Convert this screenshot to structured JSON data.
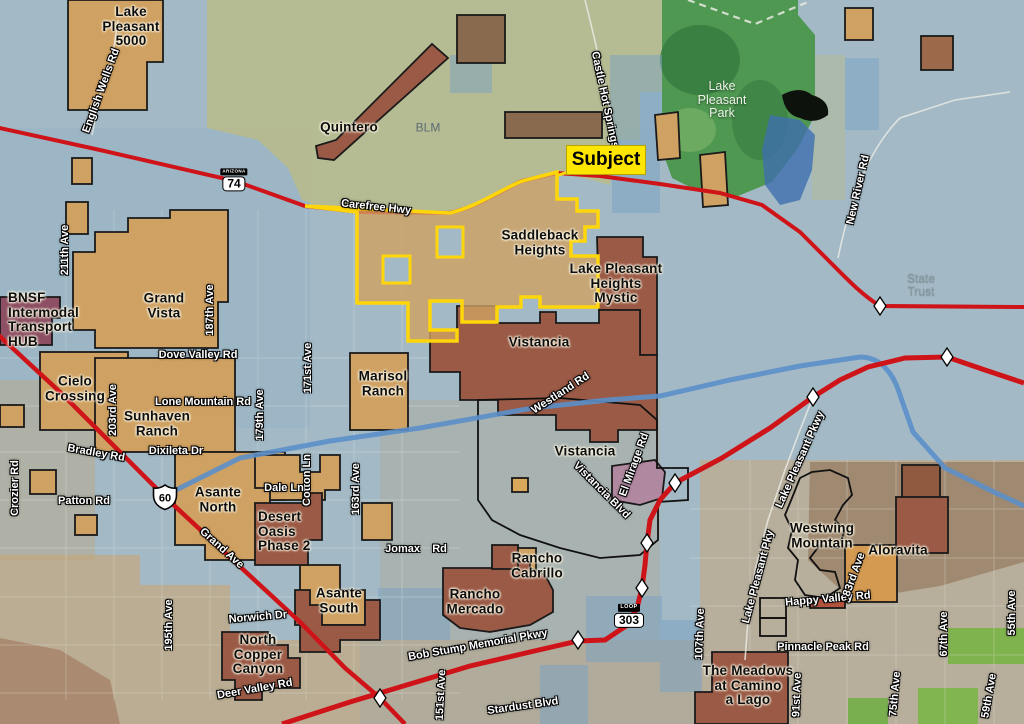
{
  "map": {
    "callout": {
      "label": "Subject"
    },
    "colors": {
      "base_water_blue": "#a3bac6",
      "blm_olive": "#b6ba90",
      "park_green": "#4f9851",
      "parcel_tan": "#cfa162",
      "parcel_red_brown": "#9a5a46",
      "parcel_purple": "#8d4f63",
      "parcel_mauve": "#b088a0",
      "highway_red": "#cf1419",
      "subject_yellow": "#ffd60a",
      "river_blue": "#5b8fc9",
      "diamond_white": "#ffffff"
    },
    "area_labels": [
      {
        "name": "label-lake-pleasant-5000",
        "text": "Lake\nPleasant\n5000",
        "x": 131,
        "y": 27,
        "style": "community"
      },
      {
        "name": "label-quintero",
        "text": "Quintero",
        "x": 349,
        "y": 128,
        "style": "community"
      },
      {
        "name": "label-blm",
        "text": "BLM",
        "x": 428,
        "y": 128,
        "style": "dim"
      },
      {
        "name": "label-lake-pleasant-park",
        "text": "Lake\nPleasant\nPark",
        "x": 722,
        "y": 100,
        "style": "park"
      },
      {
        "name": "label-saddleback-heights",
        "text": "Saddleback\nHeights",
        "x": 540,
        "y": 243,
        "style": "community"
      },
      {
        "name": "label-lake-pleasant-heights-mystic",
        "text": "Lake Pleasant\nHeights\nMystic",
        "x": 616,
        "y": 284,
        "style": "community"
      },
      {
        "name": "label-vistancia-north",
        "text": "Vistancia",
        "x": 539,
        "y": 343,
        "style": "community"
      },
      {
        "name": "label-vistancia-south",
        "text": "Vistancia",
        "x": 585,
        "y": 452,
        "style": "community"
      },
      {
        "name": "label-grand-vista",
        "text": "Grand\nVista",
        "x": 164,
        "y": 306,
        "style": "community"
      },
      {
        "name": "label-bnsf-hub",
        "text": "BNSF\nIntermodal\nTransport\nHUB",
        "x": 8,
        "y": 320,
        "style": "community",
        "align": "left"
      },
      {
        "name": "label-cielo-crossing",
        "text": "Cielo\nCrossing",
        "x": 75,
        "y": 389,
        "style": "community"
      },
      {
        "name": "label-sunhaven-ranch",
        "text": "Sunhaven\nRanch",
        "x": 157,
        "y": 424,
        "style": "community"
      },
      {
        "name": "label-marisol-ranch",
        "text": "Marisol\nRanch",
        "x": 383,
        "y": 384,
        "style": "community"
      },
      {
        "name": "label-asante-north",
        "text": "Asante\nNorth",
        "x": 218,
        "y": 500,
        "style": "community"
      },
      {
        "name": "label-desert-oasis-phase-2",
        "text": "Desert\nOasis\nPhase 2",
        "x": 258,
        "y": 532,
        "style": "community",
        "align": "left"
      },
      {
        "name": "label-asante-south",
        "text": "Asante\nSouth",
        "x": 339,
        "y": 601,
        "style": "community"
      },
      {
        "name": "label-north-copper-canyon",
        "text": "North\nCopper\nCanyon",
        "x": 258,
        "y": 655,
        "style": "community"
      },
      {
        "name": "label-rancho-cabrillo",
        "text": "Rancho\nCabrillo",
        "x": 537,
        "y": 566,
        "style": "community"
      },
      {
        "name": "label-rancho-mercado",
        "text": "Rancho\nMercado",
        "x": 475,
        "y": 602,
        "style": "community"
      },
      {
        "name": "label-westwing-mountain",
        "text": "Westwing\nMountain",
        "x": 822,
        "y": 536,
        "style": "community"
      },
      {
        "name": "label-aloravita",
        "text": "Aloravita",
        "x": 898,
        "y": 551,
        "style": "community"
      },
      {
        "name": "label-the-meadows-at-camino-a-lago",
        "text": "The Meadows\nat Camino\na Lago",
        "x": 748,
        "y": 686,
        "style": "community"
      },
      {
        "name": "label-state-trust",
        "text": "State\nTrust",
        "x": 921,
        "y": 285,
        "style": "dim-light"
      }
    ],
    "road_labels": [
      {
        "text": "English Wells Rd",
        "x": 102,
        "y": 91,
        "r": -70
      },
      {
        "text": "Carefree Hwy",
        "x": 376,
        "y": 208,
        "r": 6
      },
      {
        "text": "Castle Hot Springs",
        "x": 604,
        "y": 100,
        "r": 78
      },
      {
        "text": "New River Rd",
        "x": 859,
        "y": 190,
        "r": -77
      },
      {
        "text": "Dove Valley Rd",
        "x": 198,
        "y": 356,
        "r": 0
      },
      {
        "text": "Lone Mountain Rd",
        "x": 203,
        "y": 403,
        "r": 0
      },
      {
        "text": "Bradley Rd",
        "x": 96,
        "y": 454,
        "r": 10
      },
      {
        "text": "Dixileta Dr",
        "x": 176,
        "y": 452,
        "r": 0
      },
      {
        "text": "211th Ave",
        "x": 66,
        "y": 250,
        "r": -90
      },
      {
        "text": "203rd Ave",
        "x": 114,
        "y": 410,
        "r": -90
      },
      {
        "text": "187th Ave",
        "x": 211,
        "y": 310,
        "r": -90
      },
      {
        "text": "179th Ave",
        "x": 261,
        "y": 415,
        "r": -90
      },
      {
        "text": "171st Ave",
        "x": 309,
        "y": 368,
        "r": -90
      },
      {
        "text": "Cotton Ln",
        "x": 308,
        "y": 480,
        "r": -90
      },
      {
        "text": "Dale Ln",
        "x": 284,
        "y": 489,
        "r": 0
      },
      {
        "text": "163rd Ave",
        "x": 357,
        "y": 489,
        "r": -90
      },
      {
        "text": "195th Ave",
        "x": 170,
        "y": 625,
        "r": -90
      },
      {
        "text": "Norwich Dr",
        "x": 258,
        "y": 618,
        "r": -5
      },
      {
        "text": "Deer Valley Rd",
        "x": 255,
        "y": 690,
        "r": -10
      },
      {
        "text": "Patton Rd",
        "x": 84,
        "y": 502,
        "r": 0
      },
      {
        "text": "Crozier Rd",
        "x": 16,
        "y": 488,
        "r": -90
      },
      {
        "text": "Grand Ave",
        "x": 221,
        "y": 549,
        "r": 42
      },
      {
        "text": "Jomax    Rd",
        "x": 416,
        "y": 550,
        "r": 0
      },
      {
        "text": "Stardust Blvd",
        "x": 523,
        "y": 707,
        "r": -8
      },
      {
        "text": "151st Ave",
        "x": 442,
        "y": 695,
        "r": -87
      },
      {
        "text": "Bob Stump Memorial Pkwy",
        "x": 478,
        "y": 646,
        "r": -10
      },
      {
        "text": "107th Ave",
        "x": 701,
        "y": 634,
        "r": -88
      },
      {
        "text": "Westland Rd",
        "x": 561,
        "y": 394,
        "r": -33
      },
      {
        "text": "Vistancia Blvd",
        "x": 601,
        "y": 491,
        "r": 45
      },
      {
        "text": "El Mirage Rd",
        "x": 635,
        "y": 465,
        "r": -70
      },
      {
        "text": "Lake Pleasant Pkwy",
        "x": 801,
        "y": 460,
        "r": -66
      },
      {
        "text": "Lake Pleasant Pky",
        "x": 759,
        "y": 577,
        "r": -75
      },
      {
        "text": "Happy Valley Rd",
        "x": 828,
        "y": 600,
        "r": -5
      },
      {
        "text": "83rd Ave",
        "x": 855,
        "y": 575,
        "r": -70
      },
      {
        "text": "Pinnacle Peak Rd",
        "x": 823,
        "y": 648,
        "r": 0
      },
      {
        "text": "91st Ave",
        "x": 798,
        "y": 695,
        "r": -88
      },
      {
        "text": "75th Ave",
        "x": 896,
        "y": 694,
        "r": -85
      },
      {
        "text": "67th Ave",
        "x": 945,
        "y": 634,
        "r": -90
      },
      {
        "text": "55th Ave",
        "x": 1013,
        "y": 613,
        "r": -90
      },
      {
        "text": "59th Ave",
        "x": 990,
        "y": 696,
        "r": -80
      }
    ],
    "shields": [
      {
        "type": "az",
        "banner": "ARIZONA",
        "number": "74",
        "x": 234,
        "y": 180
      },
      {
        "type": "us",
        "number": "60",
        "x": 165,
        "y": 500
      },
      {
        "type": "loop",
        "banner": "LOOP",
        "number": "303",
        "x": 629,
        "y": 616
      }
    ],
    "interchange_diamonds": [
      {
        "x": 880,
        "y": 306
      },
      {
        "x": 947,
        "y": 357
      },
      {
        "x": 813,
        "y": 397
      },
      {
        "x": 675,
        "y": 483
      },
      {
        "x": 647,
        "y": 543
      },
      {
        "x": 642,
        "y": 588
      },
      {
        "x": 578,
        "y": 640
      },
      {
        "x": 380,
        "y": 698
      }
    ]
  }
}
